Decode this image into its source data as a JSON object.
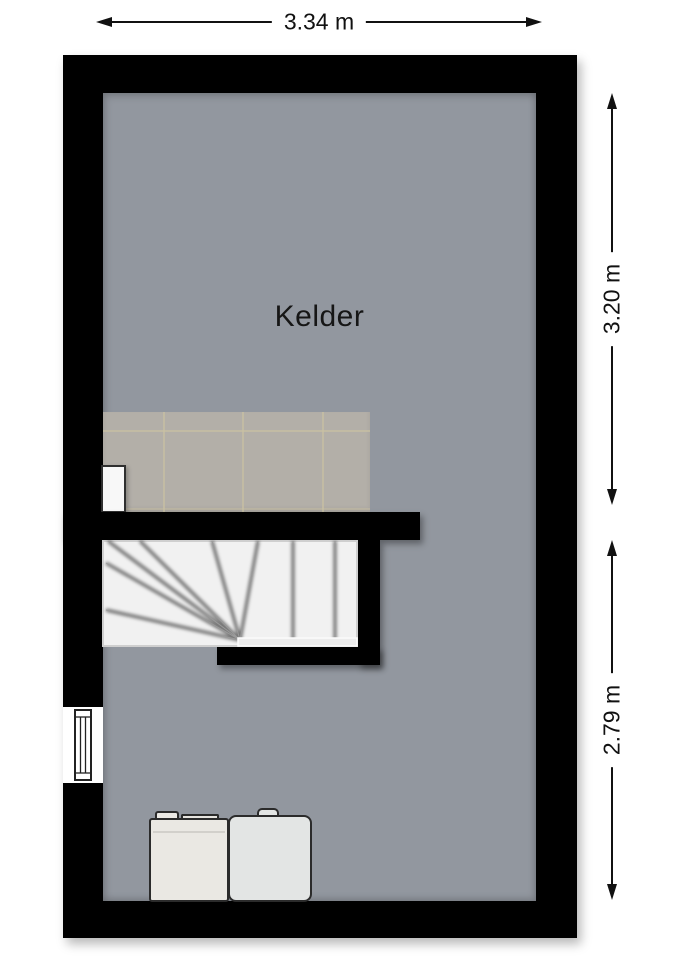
{
  "room": {
    "name": "Kelder"
  },
  "dimensions": {
    "top_width": "3.34 m",
    "right_upper_height": "3.20 m",
    "right_lower_height": "2.79 m"
  },
  "colors": {
    "wall": "#000000",
    "floor": "#92979f",
    "tile_floor": "#b3afa8",
    "tile_grid": "#c9c0a3",
    "stair_tread": "#f1f1f1",
    "washer": "#eae8e3",
    "dryer": "#e3e5e4",
    "background": "#ffffff",
    "dimension_ink": "#111111"
  },
  "objects": {
    "staircase": "winder-staircase",
    "window": "basement-window",
    "door_recess": "door-recess",
    "washer": "washing-machine",
    "dryer": "dryer",
    "tiled_area": "tiled-floor-landing"
  }
}
